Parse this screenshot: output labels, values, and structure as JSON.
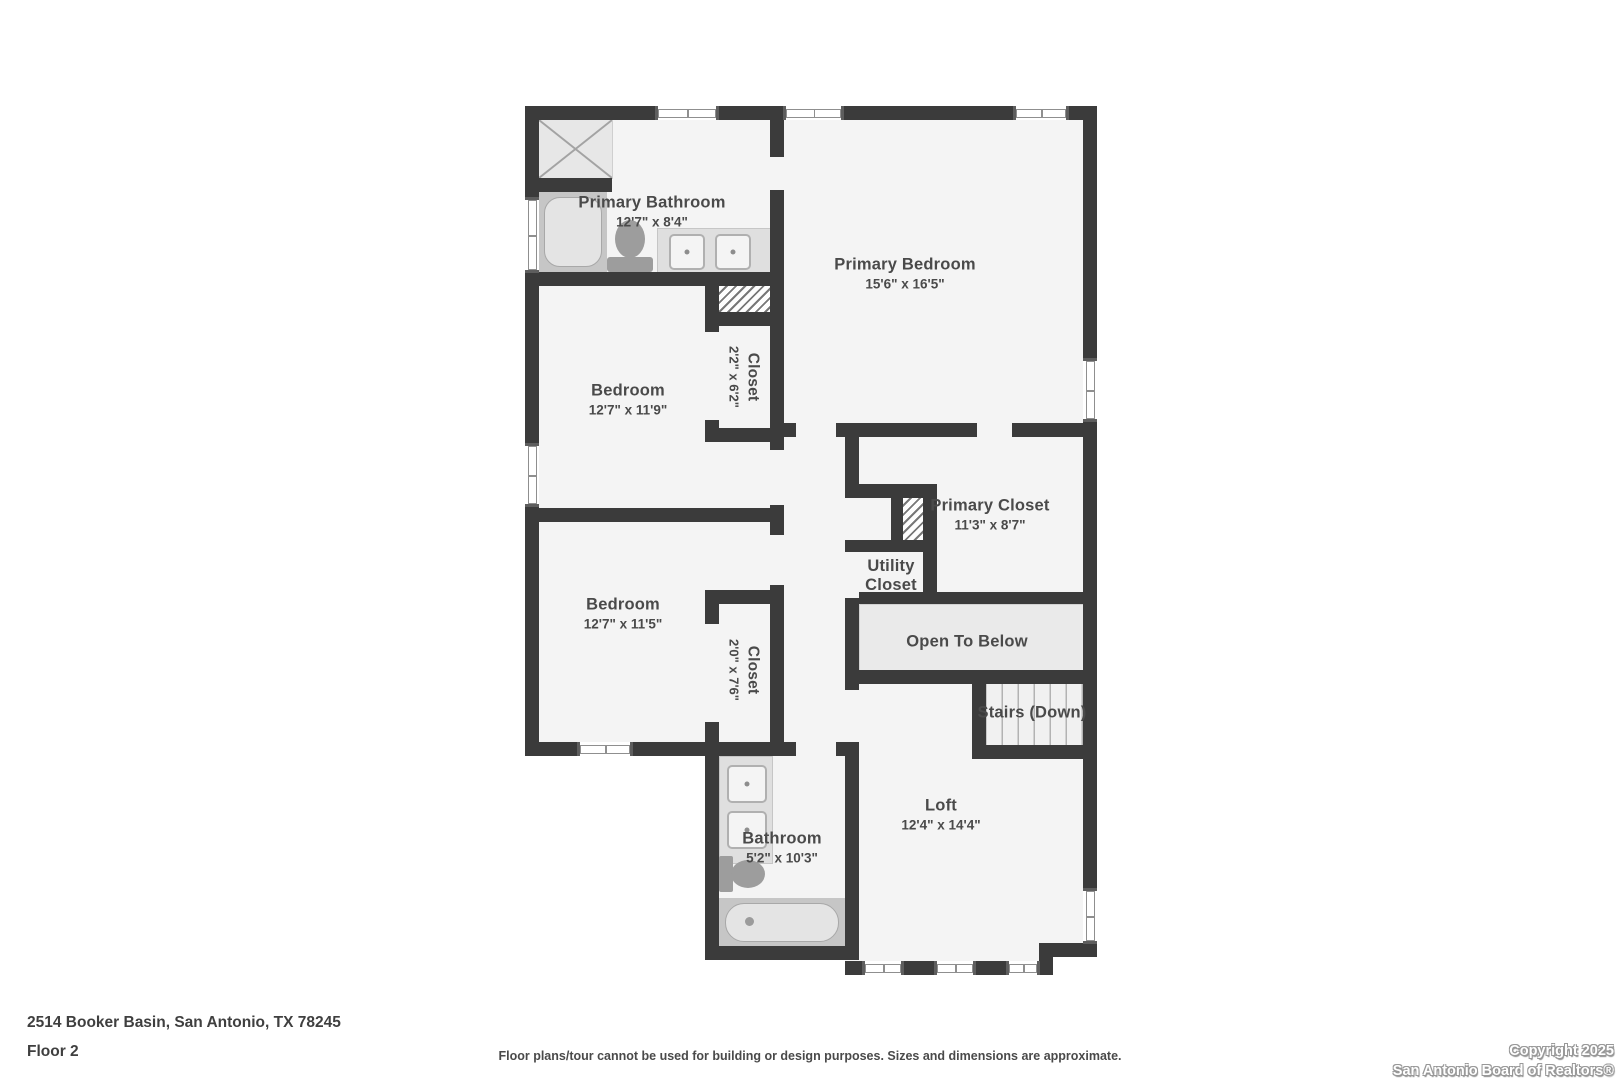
{
  "rooms": {
    "primary_bathroom": {
      "name": "Primary Bathroom",
      "dims": "12'7\" x 8'4\""
    },
    "primary_bedroom": {
      "name": "Primary Bedroom",
      "dims": "15'6\" x 16'5\""
    },
    "bedroom_1": {
      "name": "Bedroom",
      "dims": "12'7\" x 11'9\""
    },
    "closet_1": {
      "name": "Closet",
      "dims": "2'2\" x 6'2\""
    },
    "bedroom_2": {
      "name": "Bedroom",
      "dims": "12'7\" x 11'5\""
    },
    "closet_2": {
      "name": "Closet",
      "dims": "2'0\" x 7'6\""
    },
    "primary_closet": {
      "name": "Primary Closet",
      "dims": "11'3\" x 8'7\""
    },
    "utility_closet": {
      "name": "Utility Closet"
    },
    "open_to_below": {
      "name": "Open To Below"
    },
    "stairs": {
      "name": "Stairs (Down)"
    },
    "loft": {
      "name": "Loft",
      "dims": "12'4\" x 14'4\""
    },
    "bathroom": {
      "name": "Bathroom",
      "dims": "5'2\" x 10'3\""
    }
  },
  "footer": {
    "address": "2514 Booker Basin, San Antonio, TX 78245",
    "floor_label": "Floor 2",
    "disclaimer": "Floor plans/tour cannot be used for building or design purposes. Sizes and dimensions are approximate.",
    "copyright_line1": "Copyright 2025",
    "copyright_line2": "San Antonio Board of Realtors®"
  },
  "colors": {
    "wall": "#3b3b3b",
    "floor": "#f4f4f4",
    "open_to_below_fill": "#eaeaea",
    "fixture_gray": "#c6c6c6",
    "label_text": "#4a4a4a"
  }
}
